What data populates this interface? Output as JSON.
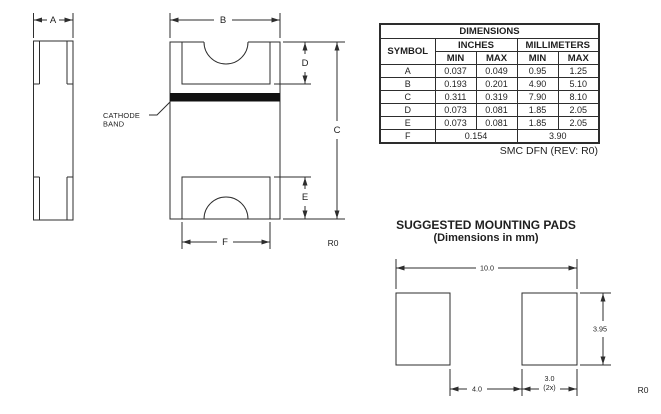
{
  "package_views": {
    "dim_labels": {
      "a": "A",
      "b": "B",
      "c": "C",
      "d": "D",
      "e": "E",
      "f": "F"
    },
    "cathode_band_label": {
      "line1": "CATHODE",
      "line2": "BAND"
    },
    "rev_label": "R0",
    "band_color": "#111111",
    "line_color": "#2d2d2d"
  },
  "dimensions_table": {
    "title": "DIMENSIONS",
    "symbol_header": "SYMBOL",
    "inches_header": "INCHES",
    "millimeters_header": "MILLIMETERS",
    "min_header": "MIN",
    "max_header": "MAX",
    "rows": [
      {
        "symbol": "A",
        "in_min": "0.037",
        "in_max": "0.049",
        "mm_min": "0.95",
        "mm_max": "1.25"
      },
      {
        "symbol": "B",
        "in_min": "0.193",
        "in_max": "0.201",
        "mm_min": "4.90",
        "mm_max": "5.10"
      },
      {
        "symbol": "C",
        "in_min": "0.311",
        "in_max": "0.319",
        "mm_min": "7.90",
        "mm_max": "8.10"
      },
      {
        "symbol": "D",
        "in_min": "0.073",
        "in_max": "0.081",
        "mm_min": "1.85",
        "mm_max": "2.05"
      },
      {
        "symbol": "E",
        "in_min": "0.073",
        "in_max": "0.081",
        "mm_min": "1.85",
        "mm_max": "2.05"
      }
    ],
    "f_row": {
      "symbol": "F",
      "inches": "0.154",
      "mm": "3.90"
    },
    "footnote": "SMC DFN (REV: R0)"
  },
  "mounting_pads": {
    "title": "SUGGESTED MOUNTING PADS",
    "subtitle": "(Dimensions in mm)",
    "overall_width": "10.0",
    "pad_height": "3.95",
    "pad_gap": "4.0",
    "pad_width": "3.0",
    "pad_width_qty": "(2x)",
    "rev_label": "R0"
  }
}
